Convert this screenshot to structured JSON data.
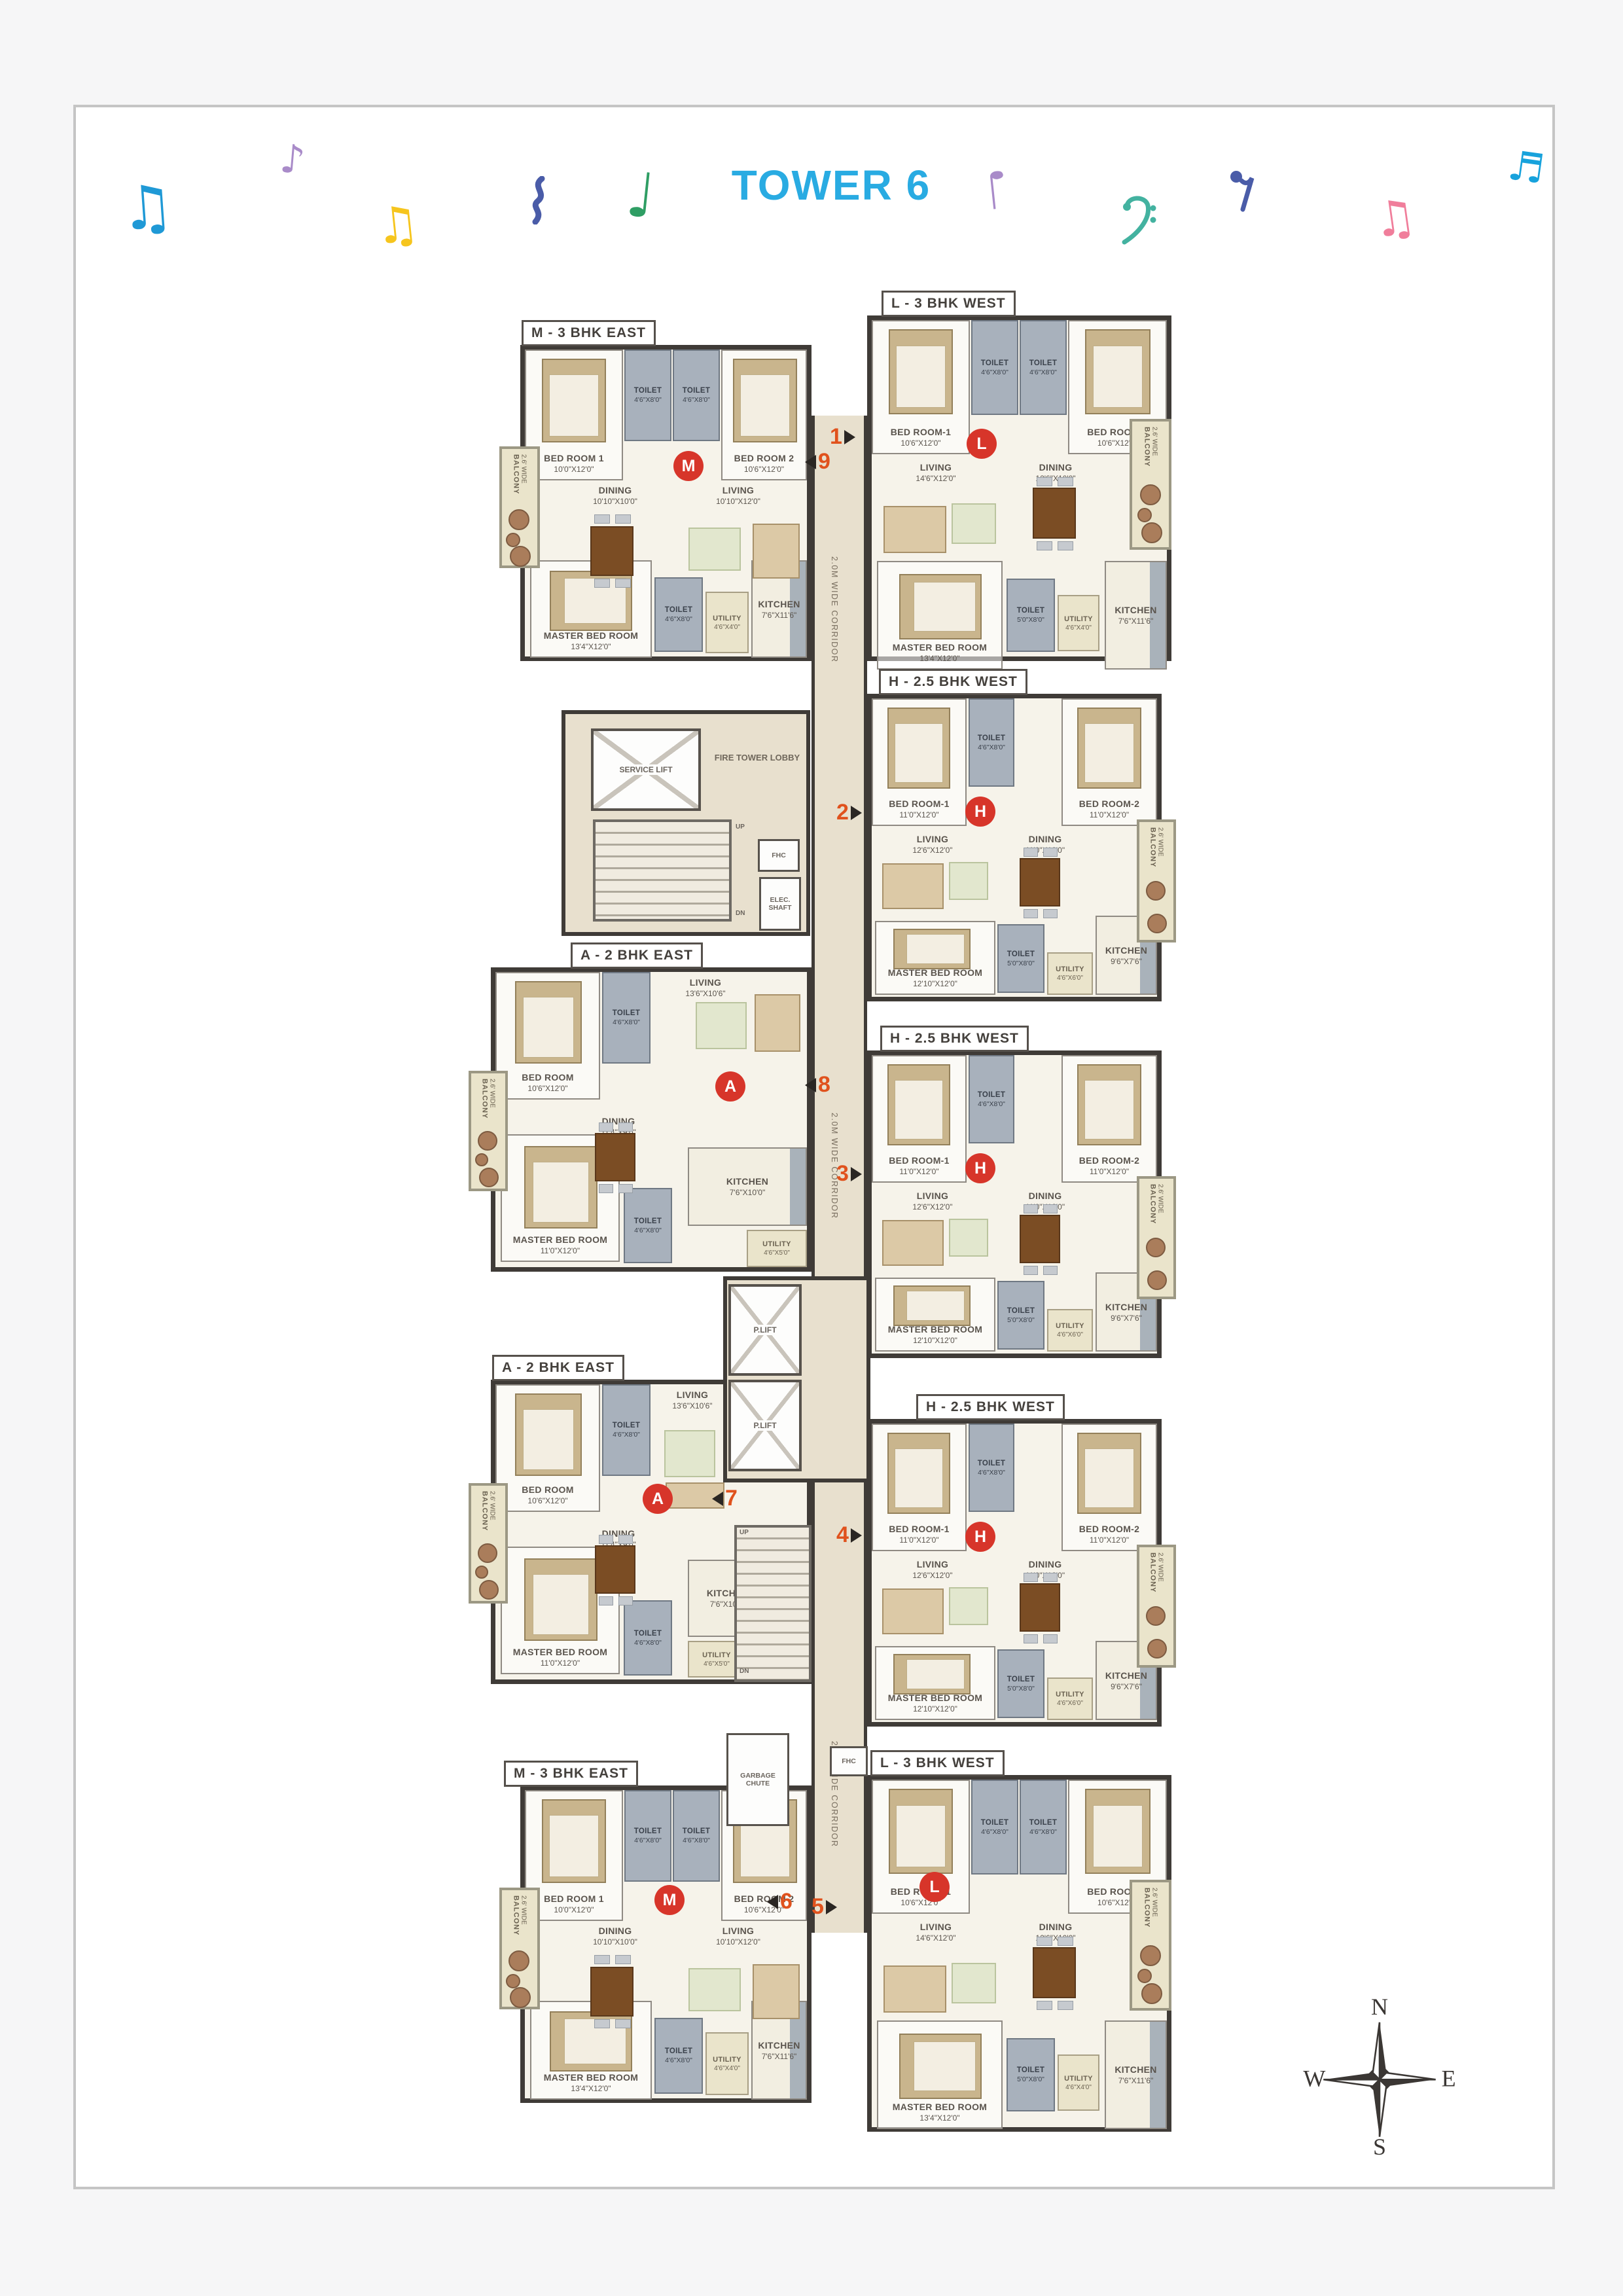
{
  "title": "TOWER 6",
  "title_color": "#29ABE2",
  "palette": {
    "wall": "#3F3B37",
    "floor": "#F6F3EA",
    "corridor": "#E8E0CE",
    "toilet": "#A8B1BC",
    "balcony": "#EAE4CB",
    "unit_circle_red": "#D7352A",
    "number_orange": "#E0521D",
    "card_border": "#C5C5C5"
  },
  "corridor_label": "2.0M WIDE CORRIDOR",
  "core": {
    "service_lift": "SERVICE LIFT",
    "fire_tower_lobby": "FIRE TOWER LOBBY",
    "up": "UP",
    "dn": "DN",
    "fhc": "FHC",
    "elec_shaft": "ELEC. SHAFT",
    "p_lift": "P.LIFT",
    "garbage_chute": "GARBAGE CHUTE"
  },
  "unit_numbers": [
    "1",
    "9",
    "2",
    "8",
    "3",
    "7",
    "4",
    "6",
    "5"
  ],
  "compass": {
    "n": "N",
    "s": "S",
    "e": "E",
    "w": "W"
  },
  "music_notes": [
    {
      "name": "beamed-note",
      "glyph": "♫",
      "color": "#1F99D6"
    },
    {
      "name": "eighth-note",
      "glyph": "♪",
      "color": "#A98BC9"
    },
    {
      "name": "beamed-note",
      "glyph": "♫",
      "color": "#F6C51E"
    },
    {
      "name": "squiggle",
      "color": "#4A5CA8"
    },
    {
      "name": "quarter-note",
      "glyph": "♩",
      "color": "#2F9E64"
    },
    {
      "name": "quarter-note-inverted",
      "glyph": "♩",
      "color": "#A98BC9"
    },
    {
      "name": "bass-clef",
      "color": "#43B2A0"
    },
    {
      "name": "eighth-rest",
      "color": "#4A5CA8"
    },
    {
      "name": "beamed-note",
      "glyph": "♫",
      "color": "#F07E9B"
    },
    {
      "name": "sixteenth-note",
      "glyph": "♬",
      "color": "#17A2DC"
    }
  ],
  "units": [
    {
      "label": "M - 3 BHK EAST",
      "letter": "M",
      "rooms": {
        "bed1": {
          "n": "BED ROOM 1",
          "d": "10'0\"X12'0\""
        },
        "toi1": {
          "n": "TOILET",
          "d": "4'6\"X8'0\""
        },
        "toi2": {
          "n": "TOILET",
          "d": "4'6\"X8'0\""
        },
        "bed2": {
          "n": "BED ROOM 2",
          "d": "10'6\"X12'0\""
        },
        "dining": {
          "n": "DINING",
          "d": "10'10\"X10'0\""
        },
        "living": {
          "n": "LIVING",
          "d": "10'10\"X12'0\""
        },
        "balcony": {
          "n": "BALCONY",
          "d": "2.6' WIDE"
        },
        "master": {
          "n": "MASTER BED ROOM",
          "d": "13'4\"X12'0\""
        },
        "toi3": {
          "n": "TOILET",
          "d": "4'6\"X8'0\""
        },
        "utility": {
          "n": "UTILITY",
          "d": "4'6\"X4'0\""
        },
        "kitchen": {
          "n": "KITCHEN",
          "d": "7'6\"X11'6\""
        }
      }
    },
    {
      "label": "L - 3 BHK WEST",
      "letter": "L",
      "rooms": {
        "bed1": {
          "n": "BED ROOM-1",
          "d": "10'6\"X12'0\""
        },
        "toi1": {
          "n": "TOILET",
          "d": "4'6\"X8'0\""
        },
        "toi2": {
          "n": "TOILET",
          "d": "4'6\"X8'0\""
        },
        "bed2": {
          "n": "BED ROOM-2",
          "d": "10'6\"X12'0\""
        },
        "living": {
          "n": "LIVING",
          "d": "14'6\"X12'0\""
        },
        "dining": {
          "n": "DINING",
          "d": "12'6\"X10'0\""
        },
        "balcony": {
          "n": "BALCONY",
          "d": "2.6' WIDE"
        },
        "master": {
          "n": "MASTER BED ROOM",
          "d": "13'4\"X12'0\""
        },
        "toi3": {
          "n": "TOILET",
          "d": "5'0\"X8'0\""
        },
        "utility": {
          "n": "UTILITY",
          "d": "4'6\"X4'0\""
        },
        "kitchen": {
          "n": "KITCHEN",
          "d": "7'6\"X11'6\""
        }
      }
    },
    {
      "label": "H - 2.5 BHK WEST",
      "letter": "H",
      "rooms": {
        "bed1": {
          "n": "BED ROOM-1",
          "d": "11'0\"X12'0\""
        },
        "toi1": {
          "n": "TOILET",
          "d": "4'6\"X8'0\""
        },
        "bed2": {
          "n": "BED ROOM-2",
          "d": "11'0\"X12'0\""
        },
        "living": {
          "n": "LIVING",
          "d": "12'6\"X12'0\""
        },
        "dining": {
          "n": "DINING",
          "d": "11'0\"X12'0\""
        },
        "balcony": {
          "n": "BALCONY",
          "d": "2.6' WIDE"
        },
        "master": {
          "n": "MASTER BED ROOM",
          "d": "12'10\"X12'0\""
        },
        "toi2": {
          "n": "TOILET",
          "d": "5'0\"X8'0\""
        },
        "utility": {
          "n": "UTILITY",
          "d": "4'6\"X6'0\""
        },
        "kitchen": {
          "n": "KITCHEN",
          "d": "9'6\"X7'6\""
        }
      }
    },
    {
      "label": "A - 2 BHK EAST",
      "letter": "A",
      "rooms": {
        "bed1": {
          "n": "BED ROOM",
          "d": "10'6\"X12'0\""
        },
        "toi1": {
          "n": "TOILET",
          "d": "4'6\"X8'0\""
        },
        "living": {
          "n": "LIVING",
          "d": "13'6\"X10'6\""
        },
        "balcony": {
          "n": "BALCONY",
          "d": "2.6' WIDE"
        },
        "dining": {
          "n": "DINING",
          "d": "11'4\"X9'0\""
        },
        "master": {
          "n": "MASTER BED ROOM",
          "d": "11'0\"X12'0\""
        },
        "toi2": {
          "n": "TOILET",
          "d": "4'6\"X8'0\""
        },
        "kitchen": {
          "n": "KITCHEN",
          "d": "7'6\"X10'0\""
        },
        "utility": {
          "n": "UTILITY",
          "d": "4'6\"X5'0\""
        }
      }
    },
    {
      "label": "H - 2.5 BHK WEST",
      "letter": "H",
      "rooms": {
        "bed1": {
          "n": "BED ROOM-1",
          "d": "11'0\"X12'0\""
        },
        "toi1": {
          "n": "TOILET",
          "d": "4'6\"X8'0\""
        },
        "bed2": {
          "n": "BED ROOM-2",
          "d": "11'0\"X12'0\""
        },
        "living": {
          "n": "LIVING",
          "d": "12'6\"X12'0\""
        },
        "dining": {
          "n": "DINING",
          "d": "11'0\"X12'0\""
        },
        "balcony": {
          "n": "BALCONY",
          "d": "2.6' WIDE"
        },
        "master": {
          "n": "MASTER BED ROOM",
          "d": "12'10\"X12'0\""
        },
        "toi2": {
          "n": "TOILET",
          "d": "5'0\"X8'0\""
        },
        "utility": {
          "n": "UTILITY",
          "d": "4'6\"X6'0\""
        },
        "kitchen": {
          "n": "KITCHEN",
          "d": "9'6\"X7'6\""
        }
      }
    },
    {
      "label": "A - 2 BHK EAST",
      "letter": "A",
      "rooms": {
        "bed1": {
          "n": "BED ROOM",
          "d": "10'6\"X12'0\""
        },
        "toi1": {
          "n": "TOILET",
          "d": "4'6\"X8'0\""
        },
        "living": {
          "n": "LIVING",
          "d": "13'6\"X10'6\""
        },
        "balcony": {
          "n": "BALCONY",
          "d": "2.6' WIDE"
        },
        "dining": {
          "n": "DINING",
          "d": "11'4\"X9'0\""
        },
        "master": {
          "n": "MASTER BED ROOM",
          "d": "11'0\"X12'0\""
        },
        "toi2": {
          "n": "TOILET",
          "d": "4'6\"X8'0\""
        },
        "kitchen": {
          "n": "KITCHEN",
          "d": "7'6\"X10'0\""
        },
        "utility": {
          "n": "UTILITY",
          "d": "4'6\"X5'0\""
        }
      }
    },
    {
      "label": "H - 2.5 BHK WEST",
      "letter": "H",
      "rooms": {
        "bed1": {
          "n": "BED ROOM-1",
          "d": "11'0\"X12'0\""
        },
        "toi1": {
          "n": "TOILET",
          "d": "4'6\"X8'0\""
        },
        "bed2": {
          "n": "BED ROOM-2",
          "d": "11'0\"X12'0\""
        },
        "living": {
          "n": "LIVING",
          "d": "12'6\"X12'0\""
        },
        "dining": {
          "n": "DINING",
          "d": "11'0\"X12'0\""
        },
        "balcony": {
          "n": "BALCONY",
          "d": "2.6' WIDE"
        },
        "master": {
          "n": "MASTER BED ROOM",
          "d": "12'10\"X12'0\""
        },
        "toi2": {
          "n": "TOILET",
          "d": "5'0\"X8'0\""
        },
        "utility": {
          "n": "UTILITY",
          "d": "4'6\"X6'0\""
        },
        "kitchen": {
          "n": "KITCHEN",
          "d": "9'6\"X7'6\""
        }
      }
    },
    {
      "label": "M - 3 BHK EAST",
      "letter": "M",
      "rooms": {
        "bed1": {
          "n": "BED ROOM 1",
          "d": "10'0\"X12'0\""
        },
        "toi1": {
          "n": "TOILET",
          "d": "4'6\"X8'0\""
        },
        "toi2": {
          "n": "TOILET",
          "d": "4'6\"X8'0\""
        },
        "bed2": {
          "n": "BED ROOM 2",
          "d": "10'6\"X12'0\""
        },
        "dining": {
          "n": "DINING",
          "d": "10'10\"X10'0\""
        },
        "living": {
          "n": "LIVING",
          "d": "10'10\"X12'0\""
        },
        "balcony": {
          "n": "BALCONY",
          "d": "2.6' WIDE"
        },
        "master": {
          "n": "MASTER BED ROOM",
          "d": "13'4\"X12'0\""
        },
        "toi3": {
          "n": "TOILET",
          "d": "4'6\"X8'0\""
        },
        "utility": {
          "n": "UTILITY",
          "d": "4'6\"X4'0\""
        },
        "kitchen": {
          "n": "KITCHEN",
          "d": "7'6\"X11'6\""
        }
      }
    },
    {
      "label": "L - 3 BHK WEST",
      "letter": "L",
      "rooms": {
        "bed1": {
          "n": "BED ROOM-1",
          "d": "10'6\"X12'0\""
        },
        "toi1": {
          "n": "TOILET",
          "d": "4'6\"X8'0\""
        },
        "toi2": {
          "n": "TOILET",
          "d": "4'6\"X8'0\""
        },
        "bed2": {
          "n": "BED ROOM-2",
          "d": "10'6\"X12'0\""
        },
        "living": {
          "n": "LIVING",
          "d": "14'6\"X12'0\""
        },
        "dining": {
          "n": "DINING",
          "d": "12'6\"X10'0\""
        },
        "balcony": {
          "n": "BALCONY",
          "d": "2.6' WIDE"
        },
        "master": {
          "n": "MASTER BED ROOM",
          "d": "13'4\"X12'0\""
        },
        "toi3": {
          "n": "TOILET",
          "d": "5'0\"X8'0\""
        },
        "utility": {
          "n": "UTILITY",
          "d": "4'6\"X4'0\""
        },
        "kitchen": {
          "n": "KITCHEN",
          "d": "7'6\"X11'6\""
        }
      }
    }
  ]
}
